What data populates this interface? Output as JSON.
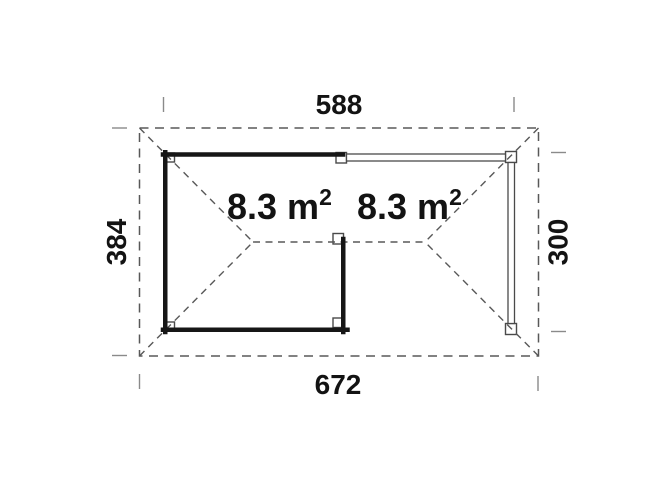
{
  "plan": {
    "description": "Floor plan top view of corner summer house with open canopy",
    "dimensions": {
      "top_width": "588",
      "bottom_width": "672",
      "left_height": "384",
      "right_height": "300"
    },
    "areas": {
      "left": {
        "main": "8.3 m",
        "sup": "2"
      },
      "right": {
        "main": "8.3 m",
        "sup": "2"
      }
    },
    "colors": {
      "background": "#ffffff",
      "wall": "#161616",
      "dashed_roof_line": "#585858",
      "beam_outline": "#4a4a4a",
      "tick": "#8a8a8a",
      "text": "#131313"
    }
  }
}
